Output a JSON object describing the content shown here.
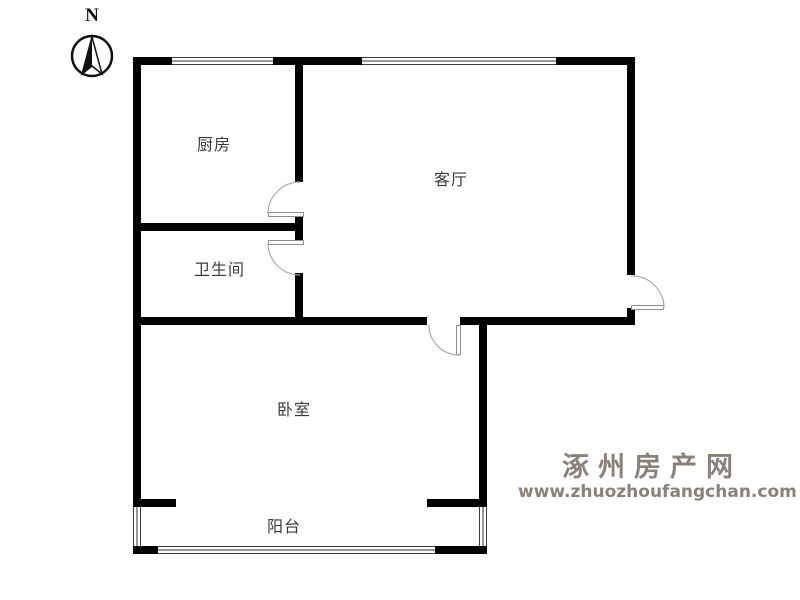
{
  "compass": {
    "label": "N"
  },
  "rooms": [
    {
      "id": "kitchen",
      "label": "厨房"
    },
    {
      "id": "living-room",
      "label": "客厅"
    },
    {
      "id": "bathroom",
      "label": "卫生间"
    },
    {
      "id": "bedroom",
      "label": "卧室"
    },
    {
      "id": "balcony",
      "label": "阳台"
    }
  ],
  "watermark": {
    "site_name": "涿州房产网",
    "site_url": "www.zhuozhoufangchan.com",
    "color": "#8a8179"
  },
  "colors": {
    "wall": "#000000",
    "door_arc": "#aaaaaa",
    "label_text": "#3a3a3a"
  }
}
